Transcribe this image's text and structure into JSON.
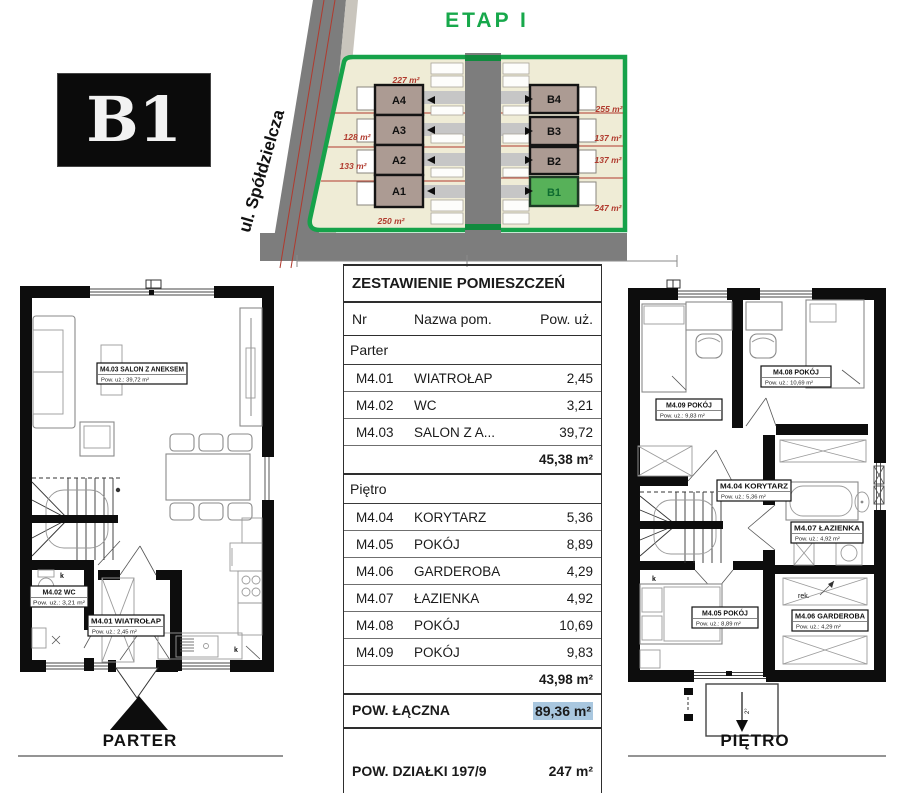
{
  "badge": {
    "label": "B1"
  },
  "site": {
    "title": "ETAP I",
    "street": "ul. Spółdzielcza",
    "buildings_left": [
      {
        "label": "A4"
      },
      {
        "label": "A3"
      },
      {
        "label": "A2"
      },
      {
        "label": "A1"
      }
    ],
    "buildings_right": [
      {
        "label": "B4"
      },
      {
        "label": "B3"
      },
      {
        "label": "B2"
      },
      {
        "label": "B1"
      }
    ],
    "areas_left": [
      "227 m²",
      "128 m²",
      "133 m²",
      "250 m²"
    ],
    "areas_right": [
      "255 m²",
      "137 m²",
      "137 m²",
      "247 m²"
    ],
    "colors": {
      "accent_green": "#17a84b",
      "parcel": "#efecd6",
      "building": "#ac9b93",
      "b1_fill": "#57b159",
      "road": "#7d7d7d",
      "boundary_red": "#b03a2e"
    }
  },
  "table": {
    "title": "ZESTAWIENIE POMIESZCZEŃ",
    "columns": {
      "nr": "Nr",
      "name": "Nazwa pom.",
      "area": "Pow. uż."
    },
    "sections": [
      {
        "name": "Parter",
        "rows": [
          {
            "nr": "M4.01",
            "name": "WIATROŁAP",
            "area": "2,45"
          },
          {
            "nr": "M4.02",
            "name": "WC",
            "area": "3,21"
          },
          {
            "nr": "M4.03",
            "name": "SALON Z A...",
            "area": "39,72"
          }
        ],
        "subtotal": "45,38 m²"
      },
      {
        "name": "Piętro",
        "rows": [
          {
            "nr": "M4.04",
            "name": "KORYTARZ",
            "area": "5,36"
          },
          {
            "nr": "M4.05",
            "name": "POKÓJ",
            "area": "8,89"
          },
          {
            "nr": "M4.06",
            "name": "GARDEROBA",
            "area": "4,29"
          },
          {
            "nr": "M4.07",
            "name": "ŁAZIENKA",
            "area": "4,92"
          },
          {
            "nr": "M4.08",
            "name": "POKÓJ",
            "area": "10,69"
          },
          {
            "nr": "M4.09",
            "name": "POKÓJ",
            "area": "9,83"
          }
        ],
        "subtotal": "43,98 m²"
      }
    ],
    "total_label": "POW. ŁĄCZNA",
    "total_value": "89,36 m²",
    "plot_label": "POW. DZIAŁKI 197/9",
    "plot_value": "247 m²",
    "highlight_color": "#a9c7df"
  },
  "parter": {
    "caption": "PARTER",
    "k_label": "k",
    "rooms": {
      "salon": {
        "name": "M4.03 SALON Z ANEKSEM",
        "area": "Pow. uż.: 39,72 m²"
      },
      "wc": {
        "name": "M4.02 WC",
        "area": "Pow. uż.: 3,21 m²"
      },
      "wiatrolap": {
        "name": "M4.01 WIATROŁAP",
        "area": "Pow. uż.: 2,45 m²"
      }
    }
  },
  "pietro": {
    "caption": "PIĘTRO",
    "k_label": "k",
    "rek": "rek.",
    "slope": "2°",
    "rooms": {
      "p9": {
        "name": "M4.09 POKÓJ",
        "area": "Pow. uż.: 9,83 m²"
      },
      "p8": {
        "name": "M4.08 POKÓJ",
        "area": "Pow. uż.: 10,69 m²"
      },
      "korytarz": {
        "name": "M4.04 KORYTARZ",
        "area": "Pow. uż.: 5,36 m²"
      },
      "lazienka": {
        "name": "M4.07 ŁAZIENKA",
        "area": "Pow. uż.: 4,92 m²"
      },
      "p5": {
        "name": "M4.05 POKÓJ",
        "area": "Pow. uż.: 8,89 m²"
      },
      "garderoba": {
        "name": "M4.06 GARDEROBA",
        "area": "Pow. uż.: 4,29 m²"
      }
    }
  }
}
